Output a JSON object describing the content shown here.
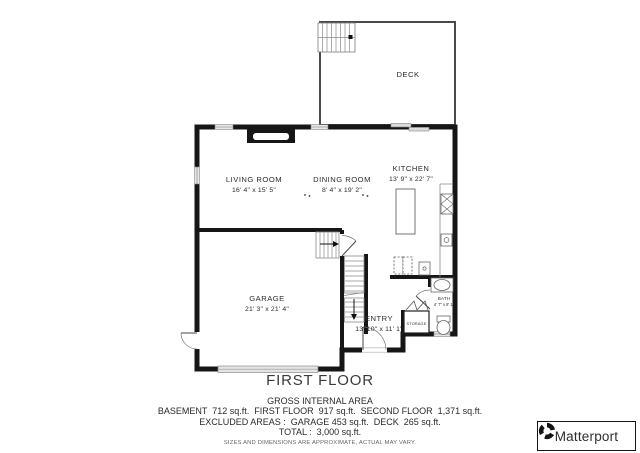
{
  "plan": {
    "floor_title": "FIRST FLOOR",
    "rooms": {
      "deck": {
        "name": "DECK"
      },
      "living_room": {
        "name": "LIVING ROOM",
        "dims": "16' 4\" x 15' 5\""
      },
      "dining_room": {
        "name": "DINING ROOM",
        "dims": "8' 4\" x 19' 2\""
      },
      "kitchen": {
        "name": "KITCHEN",
        "dims": "13' 9\" x 22' 7\""
      },
      "garage": {
        "name": "GARAGE",
        "dims": "21' 3\" x 21' 4\""
      },
      "entry": {
        "name": "ENTRY",
        "dims": "13' 10\" x 11' 1\""
      },
      "bath": {
        "name": "BATH",
        "dims": "4' 7\" x 8' 1\""
      },
      "storage": {
        "name": "STORAGE"
      }
    },
    "colors": {
      "wall": "#161616",
      "background": "#ffffff"
    }
  },
  "footer": {
    "gross_heading": "GROSS INTERNAL AREA",
    "areas_line": "BASEMENT  712 sq.ft.  FIRST FLOOR  917 sq.ft.  SECOND FLOOR  1,371 sq.ft.",
    "excluded_line": "EXCLUDED AREAS :  GARAGE 453 sq.ft.  DECK  265 sq.ft.",
    "total_line": "TOTAL :  3,000 sq.ft.",
    "disclaimer": "SIZES AND DIMENSIONS ARE APPROXIMATE, ACTUAL MAY VARY."
  },
  "branding": {
    "logo_text": "Matterport",
    "logo_icon": "matterport-pinwheel-icon"
  }
}
